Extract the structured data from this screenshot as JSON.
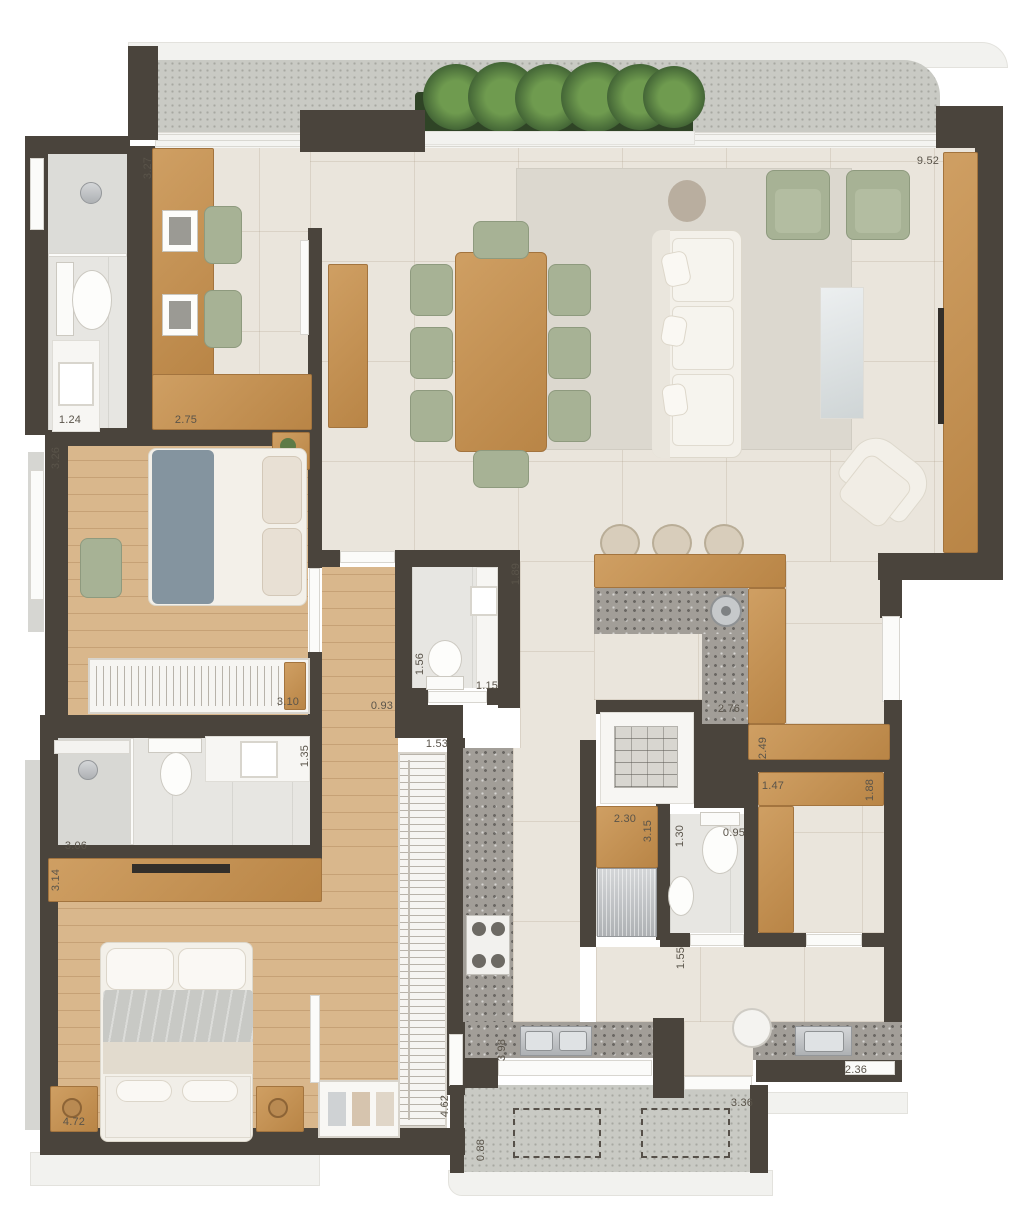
{
  "plan": {
    "type": "apartment-floor-plan",
    "dimension_labels": [
      {
        "text": "3.27",
        "cx": 148,
        "cy": 168,
        "rot": -90
      },
      {
        "text": "9.52",
        "cx": 928,
        "cy": 161,
        "rot": 0
      },
      {
        "text": "1.24",
        "cx": 70,
        "cy": 420,
        "rot": 0
      },
      {
        "text": "2.75",
        "cx": 186,
        "cy": 420,
        "rot": 0
      },
      {
        "text": "3.26",
        "cx": 56,
        "cy": 458,
        "rot": -90
      },
      {
        "text": "3.10",
        "cx": 288,
        "cy": 702,
        "rot": 0
      },
      {
        "text": "0.93",
        "cx": 382,
        "cy": 706,
        "rot": 0
      },
      {
        "text": "1.89",
        "cx": 516,
        "cy": 574,
        "rot": -90
      },
      {
        "text": "1.56",
        "cx": 420,
        "cy": 664,
        "rot": -90
      },
      {
        "text": "1.15",
        "cx": 487,
        "cy": 686,
        "rot": 0
      },
      {
        "text": "2.76",
        "cx": 729,
        "cy": 709,
        "rot": 0
      },
      {
        "text": "2.49",
        "cx": 763,
        "cy": 748,
        "rot": -90
      },
      {
        "text": "1.35",
        "cx": 305,
        "cy": 756,
        "rot": -90
      },
      {
        "text": "3.06",
        "cx": 76,
        "cy": 846,
        "rot": 0
      },
      {
        "text": "3.14",
        "cx": 56,
        "cy": 880,
        "rot": -90
      },
      {
        "text": "1.53",
        "cx": 437,
        "cy": 744,
        "rot": 0
      },
      {
        "text": "4.62",
        "cx": 445,
        "cy": 1106,
        "rot": -90
      },
      {
        "text": "4.72",
        "cx": 74,
        "cy": 1122,
        "rot": 0
      },
      {
        "text": "2.30",
        "cx": 625,
        "cy": 819,
        "rot": 0
      },
      {
        "text": "3.15",
        "cx": 648,
        "cy": 831,
        "rot": -90
      },
      {
        "text": "1.30",
        "cx": 680,
        "cy": 836,
        "rot": -90
      },
      {
        "text": "0.95",
        "cx": 734,
        "cy": 833,
        "rot": 0
      },
      {
        "text": "1.47",
        "cx": 773,
        "cy": 786,
        "rot": 0
      },
      {
        "text": "1.88",
        "cx": 870,
        "cy": 790,
        "rot": -90
      },
      {
        "text": "1.55",
        "cx": 681,
        "cy": 958,
        "rot": -90
      },
      {
        "text": "3.98",
        "cx": 502,
        "cy": 1050,
        "rot": -90
      },
      {
        "text": "0.88",
        "cx": 481,
        "cy": 1150,
        "rot": -90
      },
      {
        "text": "3.36",
        "cx": 742,
        "cy": 1103,
        "rot": 0
      },
      {
        "text": "2.36",
        "cx": 856,
        "cy": 1070,
        "rot": 0
      }
    ]
  },
  "palette": {
    "wall": "#4a443c",
    "tile_floor": "#eae5dc",
    "wood_floor": "#d9b78c",
    "wood_furniture": "#cf9f63",
    "terrace_floor": "#c9cac4",
    "terrazzo": "#a29e98",
    "green_upholstery": "#a7b295",
    "white_fabric": "#f3f0e9",
    "outer_band": "#f2f2ef",
    "rug": "#dcd8cf",
    "blanket_blue": "#84949f",
    "plant_green": "#6f9b4f",
    "label_text": "#5a544a"
  }
}
